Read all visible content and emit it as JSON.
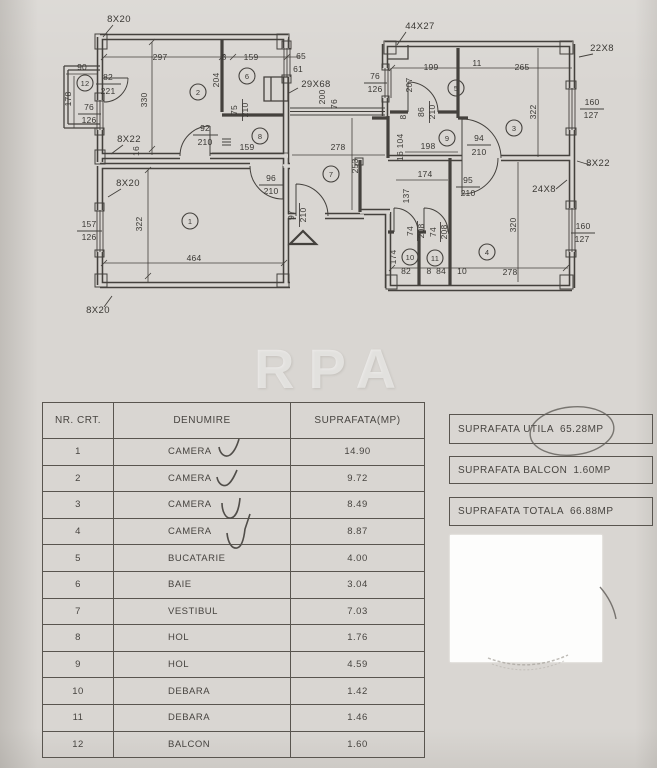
{
  "page": {
    "watermark": "RPA"
  },
  "plan": {
    "rooms": [
      "1",
      "2",
      "3",
      "4",
      "5",
      "6",
      "7",
      "8",
      "9",
      "10",
      "11",
      "12"
    ],
    "labels": [
      "8X20",
      "297",
      "8",
      "159",
      "65",
      "61",
      "90",
      "82",
      "221",
      "178",
      "330",
      "204",
      "29X68",
      "76",
      "126",
      "92",
      "210",
      "75",
      "210",
      "159",
      "8X22",
      "16",
      "200",
      "76",
      "76",
      "126",
      "207",
      "278",
      "253",
      "96",
      "210",
      "97",
      "210",
      "8X20",
      "157",
      "126",
      "322",
      "464",
      "8X20",
      "44X27",
      "199",
      "11",
      "265",
      "22X8",
      "86",
      "210",
      "94",
      "210",
      "322",
      "160",
      "127",
      "8",
      "16",
      "104",
      "198",
      "174",
      "95",
      "210",
      "24X8",
      "8X22",
      "137",
      "74",
      "208",
      "74",
      "208",
      "174",
      "320",
      "160",
      "127",
      "82",
      "8",
      "84",
      "10",
      "278"
    ]
  },
  "table": {
    "headers": [
      "NR. CRT.",
      "DENUMIRE",
      "SUPRAFATA(MP)"
    ],
    "rows": [
      {
        "no": "1",
        "name": "CAMERA",
        "area": "14.90"
      },
      {
        "no": "2",
        "name": "CAMERA",
        "area": "9.72"
      },
      {
        "no": "3",
        "name": "CAMERA",
        "area": "8.49"
      },
      {
        "no": "4",
        "name": "CAMERA",
        "area": "8.87"
      },
      {
        "no": "5",
        "name": "BUCATARIE",
        "area": "4.00"
      },
      {
        "no": "6",
        "name": "BAIE",
        "area": "3.04"
      },
      {
        "no": "7",
        "name": "VESTIBUL",
        "area": "7.03"
      },
      {
        "no": "8",
        "name": "HOL",
        "area": "1.76"
      },
      {
        "no": "9",
        "name": "HOL",
        "area": "4.59"
      },
      {
        "no": "10",
        "name": "DEBARA",
        "area": "1.42"
      },
      {
        "no": "11",
        "name": "DEBARA",
        "area": "1.46"
      },
      {
        "no": "12",
        "name": "BALCON",
        "area": "1.60"
      }
    ]
  },
  "summary": {
    "boxes": [
      {
        "label": "SUPRAFATA UTILA",
        "value": "65.28MP"
      },
      {
        "label": "SUPRAFATA BALCON",
        "value": "1.60MP"
      },
      {
        "label": "SUPRAFATA TOTALA",
        "value": "66.88MP"
      }
    ]
  }
}
